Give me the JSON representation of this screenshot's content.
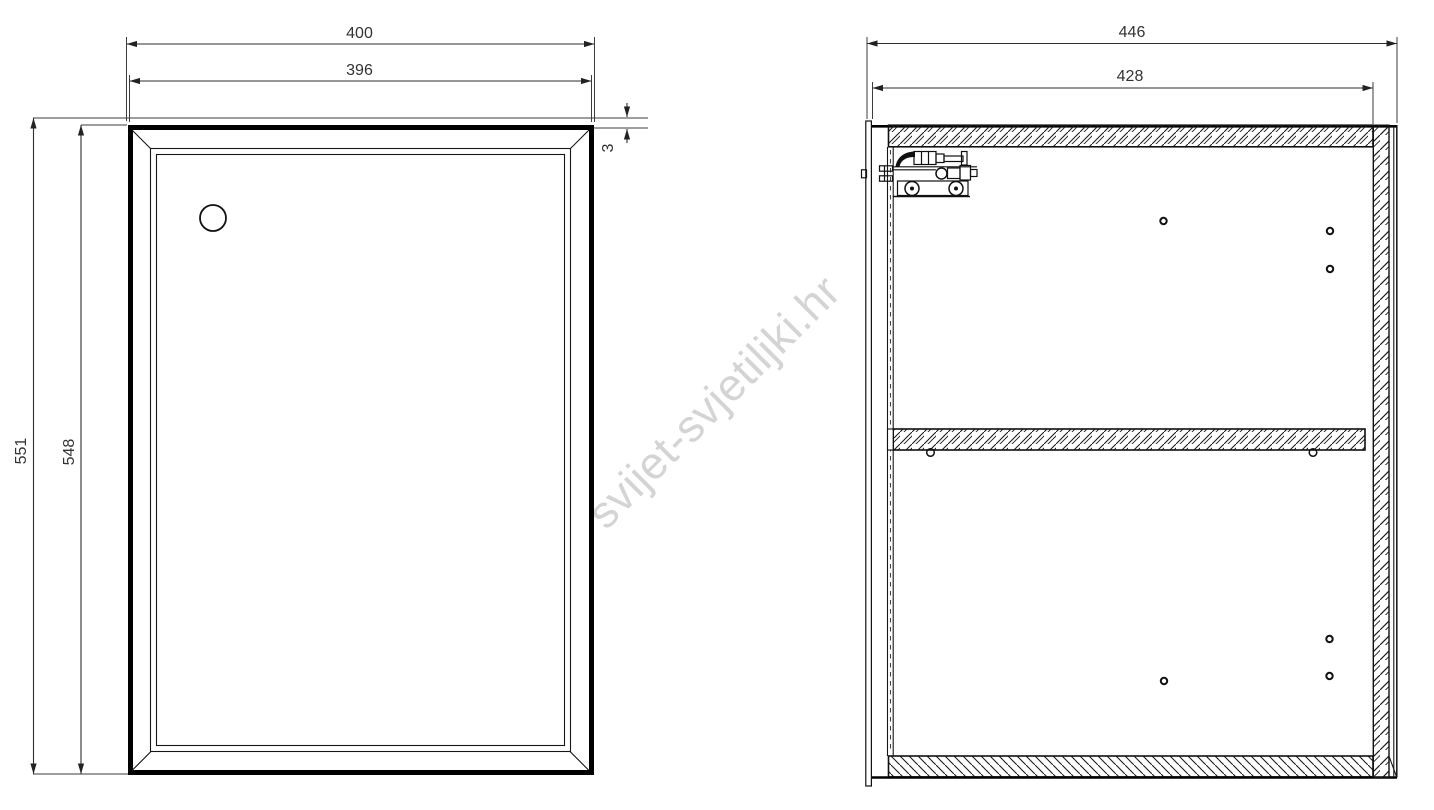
{
  "watermark": {
    "text": "svijet-svjetiljki.hr",
    "color": "#d4d4d4"
  },
  "front_view": {
    "dims": {
      "overall_width": "400",
      "door_width": "396",
      "overall_height": "551",
      "door_height": "548",
      "top_gap": "3"
    }
  },
  "side_view": {
    "dims": {
      "overall_depth": "446",
      "interior_depth": "428"
    }
  },
  "colors": {
    "line": "#161616",
    "dimension_text": "#333333",
    "watermark_gray": "#d4d4d4",
    "background": "#ffffff"
  }
}
